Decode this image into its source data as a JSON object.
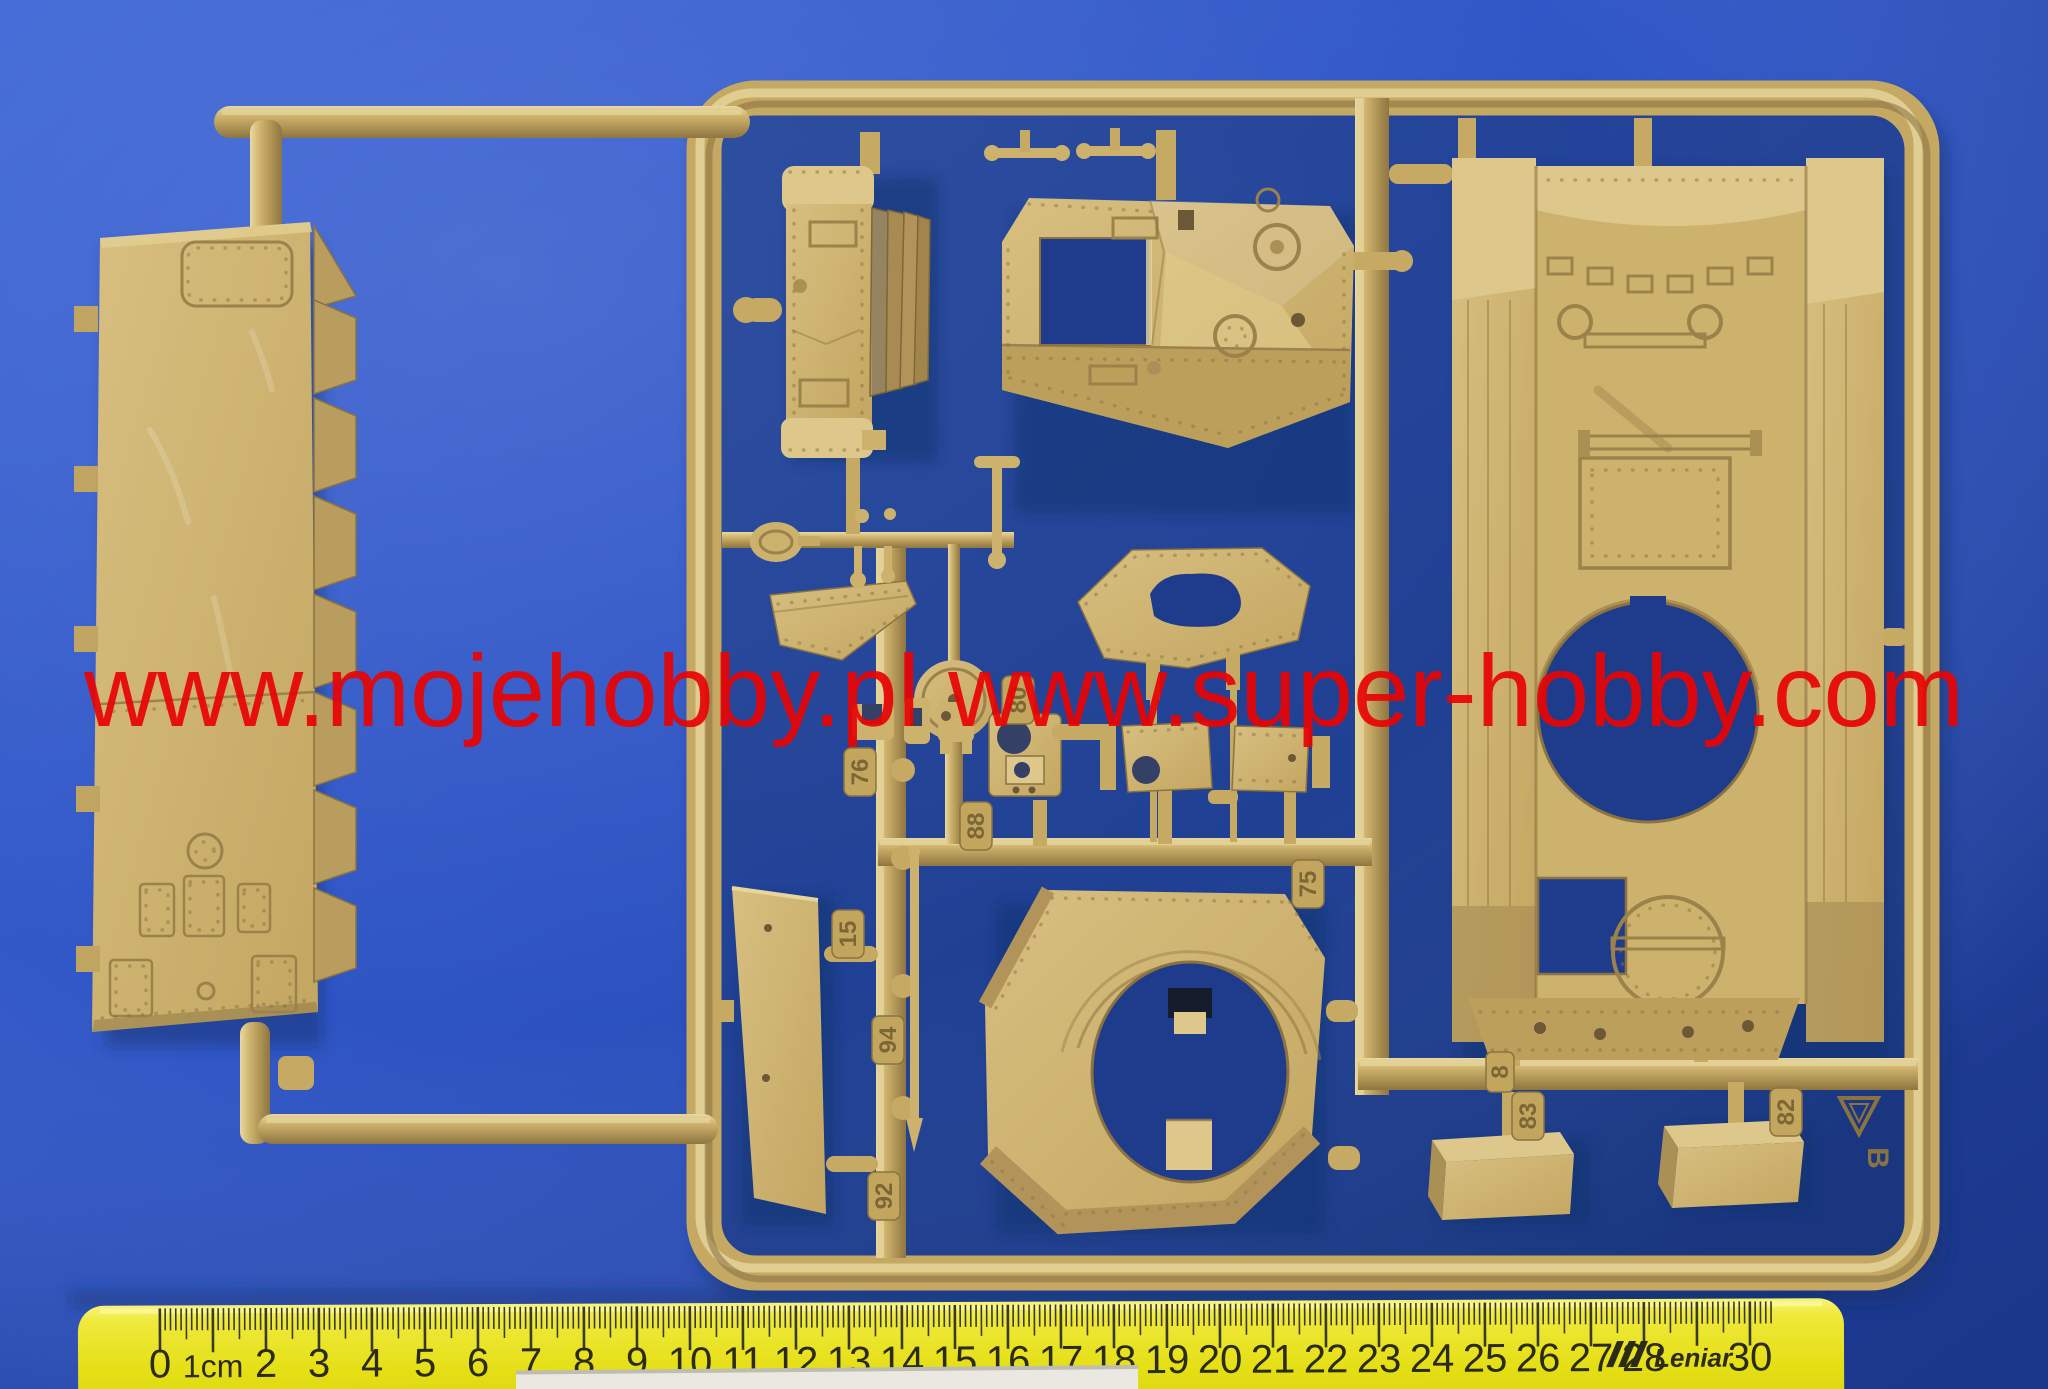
{
  "watermark": {
    "text": "www.mojehobby.pl www.super-hobby.com"
  },
  "ruler": {
    "brand": "Leniar",
    "labels": [
      "0",
      "1cm",
      "2",
      "3",
      "4",
      "5",
      "6",
      "7",
      "8",
      "9",
      "10",
      "11",
      "12",
      "13",
      "14",
      "15",
      "16",
      "17",
      "18",
      "19",
      "20",
      "21",
      "22",
      "23",
      "24",
      "25",
      "26",
      "27",
      "28",
      "",
      "30"
    ]
  },
  "sprue": {
    "letter": "B",
    "part_numbers": [
      {
        "label": "76"
      },
      {
        "label": "80"
      },
      {
        "label": "88"
      },
      {
        "label": "15"
      },
      {
        "label": "94"
      },
      {
        "label": "92"
      },
      {
        "label": "75"
      },
      {
        "label": "8"
      },
      {
        "label": "83"
      },
      {
        "label": "82"
      }
    ]
  },
  "colors": {
    "background": "#2e54c4",
    "sprue": "#cdb26e",
    "watermark": "#e80505",
    "ruler": "#e4de14",
    "paper": "#eae8e0"
  }
}
